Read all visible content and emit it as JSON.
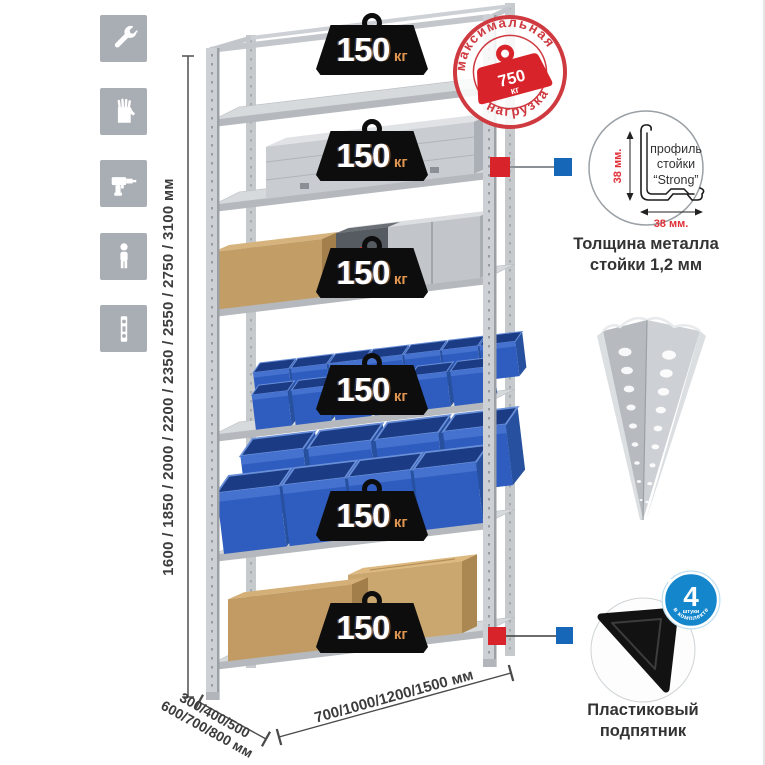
{
  "left_toolbar": {
    "icons": [
      {
        "name": "wrench-icon"
      },
      {
        "name": "gloves-icon"
      },
      {
        "name": "drill-icon"
      },
      {
        "name": "person-icon"
      },
      {
        "name": "perforated-strip-icon"
      }
    ]
  },
  "dimensions": {
    "height": "1600 / 1850 / 2000 / 2200 / 2350 / 2550 / 2750 / 3100 мм",
    "depth_line1": "300/400/500",
    "depth_line2": "600/700/800 мм",
    "width": "700/1000/1200/1500 мм"
  },
  "rack": {
    "shelf_count": 6,
    "shelf_loads": [
      {
        "value": "150",
        "unit": "кг"
      },
      {
        "value": "150",
        "unit": "кг"
      },
      {
        "value": "150",
        "unit": "кг"
      },
      {
        "value": "150",
        "unit": "кг"
      },
      {
        "value": "150",
        "unit": "кг"
      },
      {
        "value": "150",
        "unit": "кг"
      }
    ]
  },
  "stamp": {
    "arc_top": "максимальная",
    "arc_bottom": "нагрузка",
    "weight_value": "750",
    "weight_unit": "кг"
  },
  "profile_detail": {
    "label_line1": "профиль",
    "label_line2": "стойки",
    "label_line3": "“Strong”",
    "dim_vertical": "38 мм.",
    "dim_horizontal": "38 мм.",
    "caption_line1": "Толщина металла",
    "caption_line2": "стойки 1,2 мм"
  },
  "foot_detail": {
    "badge_count": "4",
    "badge_small": "штуки",
    "badge_ring": "в комплекте",
    "caption_line1": "Пластиковый",
    "caption_line2": "подпятник"
  },
  "colors": {
    "accent_red": "#d8232a",
    "accent_blue": "#1667b8",
    "bin_blue": "#2e5dbf",
    "metal_gray": "#d2d6d9",
    "icon_gray": "#a9aeb4",
    "badge_black": "#0d0d0d",
    "unit_orange": "#e09550"
  }
}
